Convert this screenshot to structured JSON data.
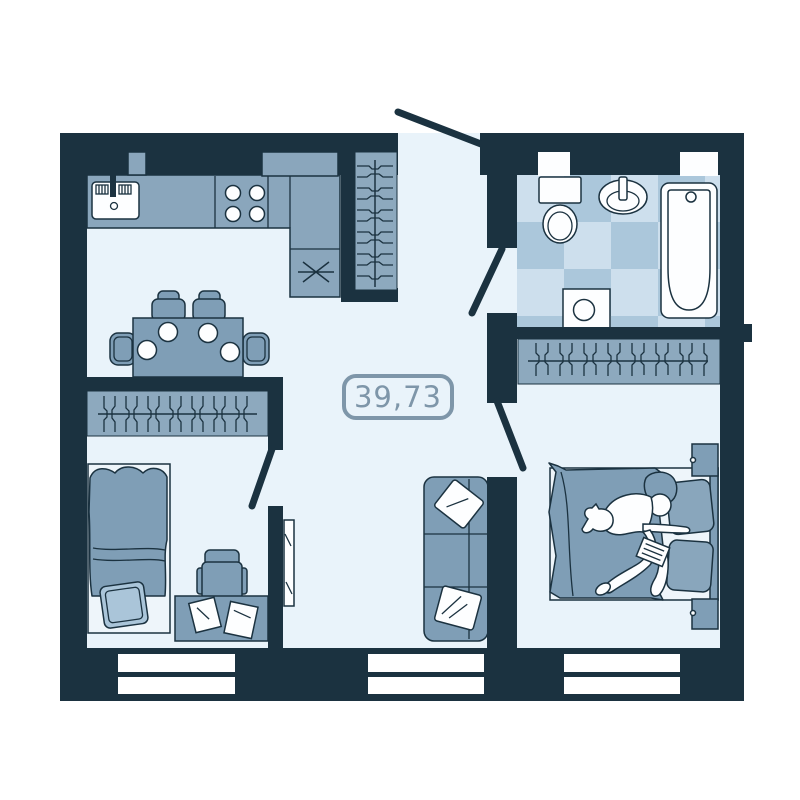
{
  "floor_plan": {
    "area_label": "39,73",
    "colors": {
      "wall": "#1b3240",
      "floor": "#e9f3fa",
      "counter": "#8aa6bc",
      "wardrobe": "#8da9be",
      "furniture": "#7f9eb6",
      "furniture_light": "#89a6bc",
      "tile_light": "#cddfed",
      "tile_dark": "#abc7db",
      "fixture_white": "#fdfeff",
      "sheet": "#eef5fa",
      "pillow": "#aac5d9",
      "label": "#7e96a9"
    },
    "furniture_icons": [
      "kitchen-sink-icon",
      "stove-icon",
      "fridge-asterisk-icon",
      "entry-wardrobe-icon",
      "dining-table-icon",
      "chair-icon",
      "wardrobe-hangers-icon",
      "single-bed-icon",
      "desk-icon",
      "desk-chair-icon",
      "papers-icon",
      "mirror-icon",
      "sofa-icon",
      "double-bed-icon",
      "person-icon",
      "cat-icon",
      "nightstand-icon",
      "toilet-icon",
      "wash-basin-icon",
      "bathtub-icon",
      "washing-machine-icon",
      "window-icon",
      "door-swing-icon"
    ]
  }
}
